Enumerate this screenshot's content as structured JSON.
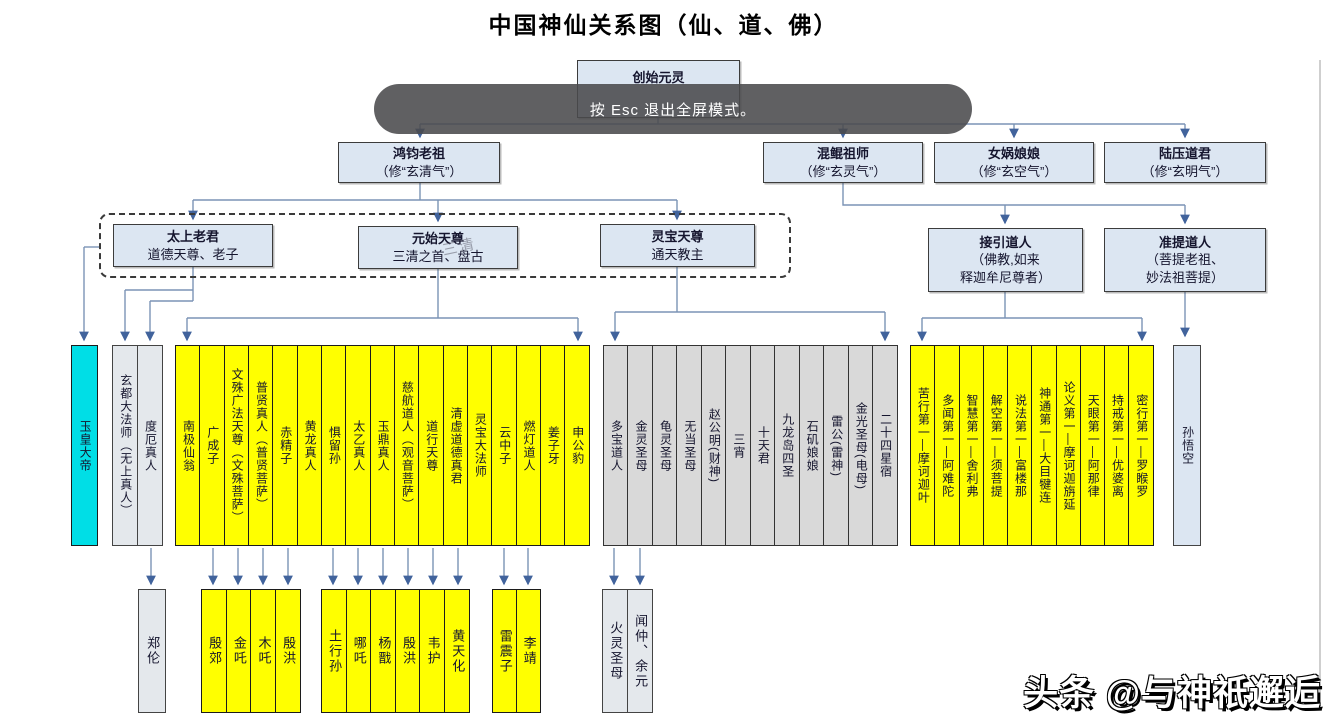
{
  "title": "中国神仙关系图（仙、道、佛）",
  "toast": "按 Esc 退出全屏模式。",
  "watermark": "头条 @与神祇邂逅",
  "sanqing_watermark": "三清",
  "root": {
    "name": "创始元灵"
  },
  "generation2": [
    {
      "name": "鸿钧老祖",
      "sub": "（修“玄清气”）"
    },
    {
      "name": "混鲲祖师",
      "sub": "（修“玄灵气”）"
    },
    {
      "name": "女娲娘娘",
      "sub": "（修“玄空气”）"
    },
    {
      "name": "陆压道君",
      "sub": "（修“玄明气”）"
    }
  ],
  "generation3": [
    {
      "name": "太上老君",
      "sub": "道德天尊、老子"
    },
    {
      "name": "元始天尊",
      "sub": "三清之首、盘古"
    },
    {
      "name": "灵宝天尊",
      "sub": "通天教主"
    },
    {
      "name": "接引道人",
      "sub": "（佛教,如来\n释迦牟尼尊者）"
    },
    {
      "name": "准提道人",
      "sub": "（菩提老祖、\n妙法祖菩提）"
    }
  ],
  "columns": {
    "jade_emperor": "玉皇大帝",
    "taishang_disciples": [
      "玄都大法师（无上真人）",
      "度厄真人"
    ],
    "chan_sect": [
      "南极仙翁",
      "广成子",
      "文殊广法天尊（文殊菩萨）",
      "普贤真人（普贤菩萨）",
      "赤精子",
      "黄龙真人",
      "惧留孙",
      "太乙真人",
      "玉鼎真人",
      "慈航道人（观音菩萨）",
      "道行天尊",
      "清虚道德真君",
      "灵宝大法师",
      "云中子",
      "燃灯道人",
      "姜子牙",
      "申公豹"
    ],
    "jie_sect": [
      "多宝道人",
      "金灵圣母",
      "龟灵圣母",
      "无当圣母",
      "赵公明(财神)",
      "三宵",
      "十天君",
      "九龙岛四圣",
      "石矶娘娘",
      "雷公(雷神)",
      "金光圣母(电母)",
      "二十四星宿"
    ],
    "buddhist_disciples": [
      "苦行第一—摩诃迦叶",
      "多闻第一—阿难陀",
      "智慧第一—舍利弗",
      "解空第一—须菩提",
      "说法第一—富楼那",
      "神通第一—大目犍连",
      "论义第一—摩诃迦旃延",
      "天眼第一—阿那律",
      "持戒第一—优婆离",
      "密行第一—罗睺罗"
    ],
    "sun_wukong": "孙悟空"
  },
  "bottom_row": {
    "zheng_lun": "郑伦",
    "group1": [
      "殷郊",
      "金吒",
      "木吒",
      "殷洪"
    ],
    "group2": [
      "土行孙",
      "哪吒",
      "杨戬",
      "殷洪",
      "韦护",
      "黄天化"
    ],
    "group3": [
      "雷震子",
      "李靖"
    ],
    "group4": [
      "火灵圣母",
      "闻仲、余元"
    ]
  },
  "colors": {
    "yellow": "#ffff00",
    "cyan": "#00dee6",
    "gray": "#d9d9d9",
    "bluegray": "#e4e8ec",
    "nodefill": "#dce6f2",
    "line": "#7b93b5",
    "arrow": "#41639c",
    "toast_bg": "rgba(74,74,76,0.88)"
  }
}
